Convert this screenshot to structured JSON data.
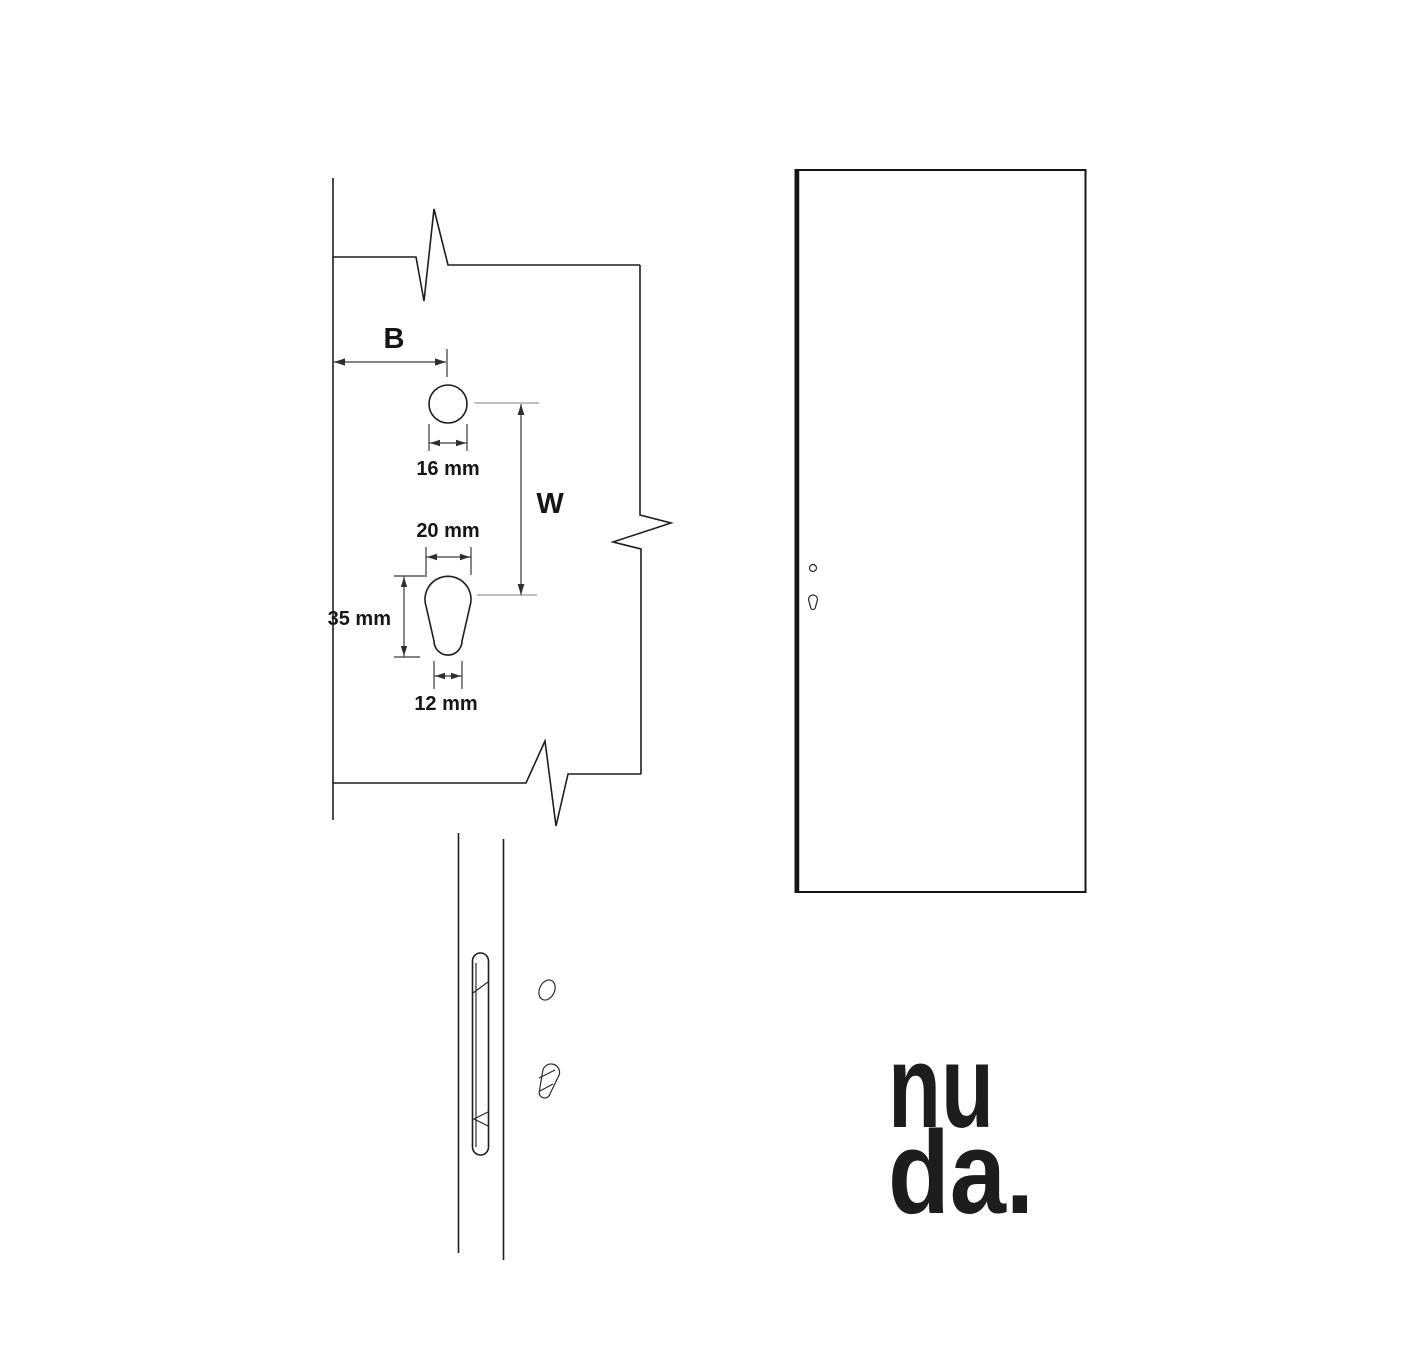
{
  "diagram": {
    "backset_label": "B",
    "spacing_label": "W",
    "hole_diameter_top": "16 mm",
    "cylinder_width": "20 mm",
    "cylinder_height": "35 mm",
    "cylinder_stem_width": "12 mm"
  },
  "logo": {
    "line1": "nu",
    "line2": "da."
  },
  "colors": {
    "background": "#ffffff",
    "outline": "#1e1e1e",
    "dimension": "#3a3a3a",
    "centerline": "#9a9a9a",
    "text": "#161616",
    "logo": "#1d1d1b"
  }
}
